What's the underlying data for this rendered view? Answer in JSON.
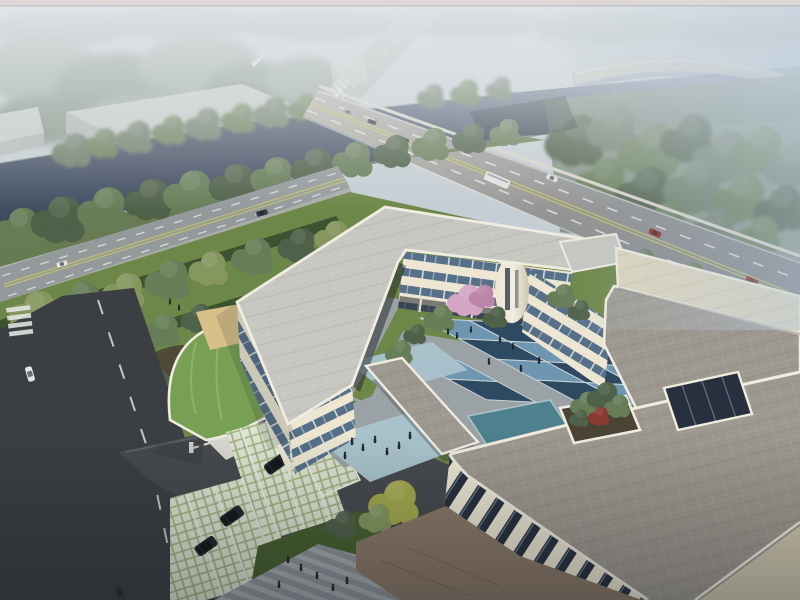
{
  "scene": {
    "kind": "architectural-aerial-rendering",
    "features": [
      "canal",
      "highway-bridge",
      "elevated-ramp",
      "tree-lined-street",
      "u-shaped-cream-building",
      "blue-checkerboard-courtyard",
      "roof-terrace-planter",
      "green-roof-gatehouse",
      "grass-grid-parking",
      "striped-plaza-walkway",
      "warehouses-in-haze"
    ]
  },
  "inventory": {
    "main_road_vehicles": 7,
    "street_vehicles": 2,
    "side_road_vehicles": 2,
    "parked_suvs": 4,
    "pink_blossom_trees": 7,
    "courtyard_tiles_visible": 18,
    "people_figures": 23
  },
  "colors": {
    "sky_top": "#ccd3d8",
    "frame_top": "#ddd8d6",
    "frame_line": "#b6aeab",
    "haze_top": "#e2e6e9",
    "haze_right": "#b7c8d9",
    "field_far": "#b9c6cd",
    "forest_far": "#93a396",
    "forest_mid": "#7c8d7c",
    "tree_olive": "#6b7b66",
    "tree_mid": "#677d57",
    "tree_dark": "#4f6149",
    "tree_light": "#85975f",
    "tree_yellow": "#a3a94e",
    "blossom": "#d2a6c4",
    "blossom_deep": "#bb86aa",
    "canal": "#3e4a5e",
    "canal_light": "#8ba0b4",
    "bank_wall": "#97a19b",
    "road_far": "#b8bbb6",
    "road_main_far": "#b4b1a9",
    "road_main_near": "#7e8084",
    "road_street": "#94999c",
    "sidewalk": "#aaaca7",
    "road_dark": "#3b3e42",
    "drive": "#46494d",
    "line_white": "#e8eae8",
    "line_yellow": "#c9c95e",
    "bridge_parapet": "#d9d5ca",
    "ramp": "#c6c4bc",
    "warehouse": "#ccd0cd",
    "warehouse_side": "#b4bab6",
    "lawn": "#6c8747",
    "lawn_dark": "#46602f",
    "lawn_mut": "#5d7245",
    "hedge": "#3c5230",
    "soil": "#4b4435",
    "green_roof": "#78a055",
    "green_roof_light": "#95b873",
    "sand": "#d8c189",
    "cream": "#ece6d2",
    "cream_shade": "#cfc7ae",
    "parapet": "#f0ece0",
    "win_dark": "#27303e",
    "win_band": "#56708a",
    "glass": "#9db4c6",
    "roof_gray": "#c7c7c1",
    "roof_pavers": "#9d988f",
    "roof_beige": "#ddd5bc",
    "court_light": "#6f96b0",
    "court_dark": "#2e4a63",
    "tile_gap": "#c9d3d6",
    "plaza": "#a9c3cc",
    "walkway": "#9aa2a6",
    "stripe_a": "#8d9499",
    "stripe_b": "#a6adb1",
    "pond": "#4e808e",
    "pond_edge": "#bcd6da",
    "apron": "#8a7868",
    "grid_light": "#dfe3d2",
    "grid_green": "#9db37e",
    "car_red": "#8e2420",
    "car_dark": "#35393d",
    "car_white": "#e4e5e1",
    "car_gray": "#8d9094",
    "suv": "#24282c",
    "people": "#23262b",
    "shadow": "#1d2328"
  }
}
